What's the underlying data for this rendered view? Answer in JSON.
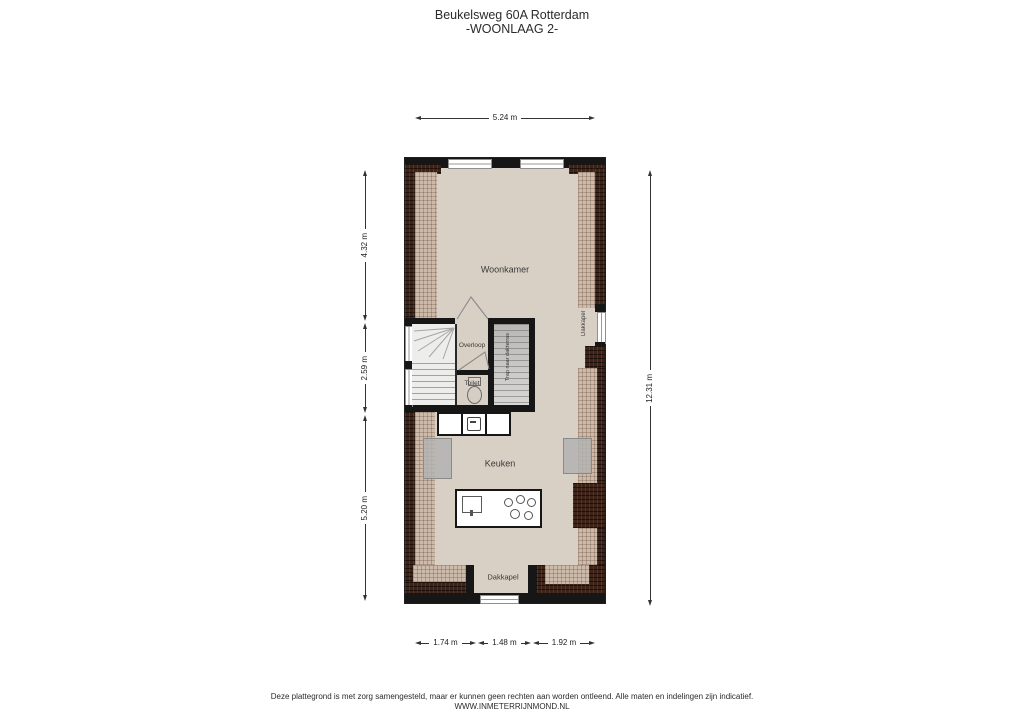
{
  "title": {
    "line1": "Beukelsweg 60A Rotterdam",
    "line2": "-WOONLAAG 2-"
  },
  "plan": {
    "rooms": {
      "woonkamer": "Woonkamer",
      "overloop": "Overloop",
      "toilet": "Toilet",
      "trap_dakterras": "Trap naar dakterras",
      "dakkapel_right": "Dakkapel",
      "keuken": "Keuken",
      "dakkapel_bottom": "Dakkapel"
    }
  },
  "dimensions": {
    "top": "5.24 m",
    "left_top": "4.32 m",
    "left_middle": "2.59 m",
    "left_bottom": "5.20 m",
    "right": "12.31 m",
    "bottom_left": "1.74 m",
    "bottom_middle": "1.48 m",
    "bottom_right": "1.92 m"
  },
  "footer": {
    "disclaimer": "Deze plattegrond is met zorg samengesteld, maar er kunnen geen rechten aan worden ontleend. Alle maten en indelingen zijn indicatief.",
    "website": "WWW.INMETERRIJNMOND.NL"
  },
  "colors": {
    "floor": "#d9d0c5",
    "wall": "#161616",
    "hatch_light": "#ccbaab",
    "hatch_dark": "#3d2317"
  }
}
